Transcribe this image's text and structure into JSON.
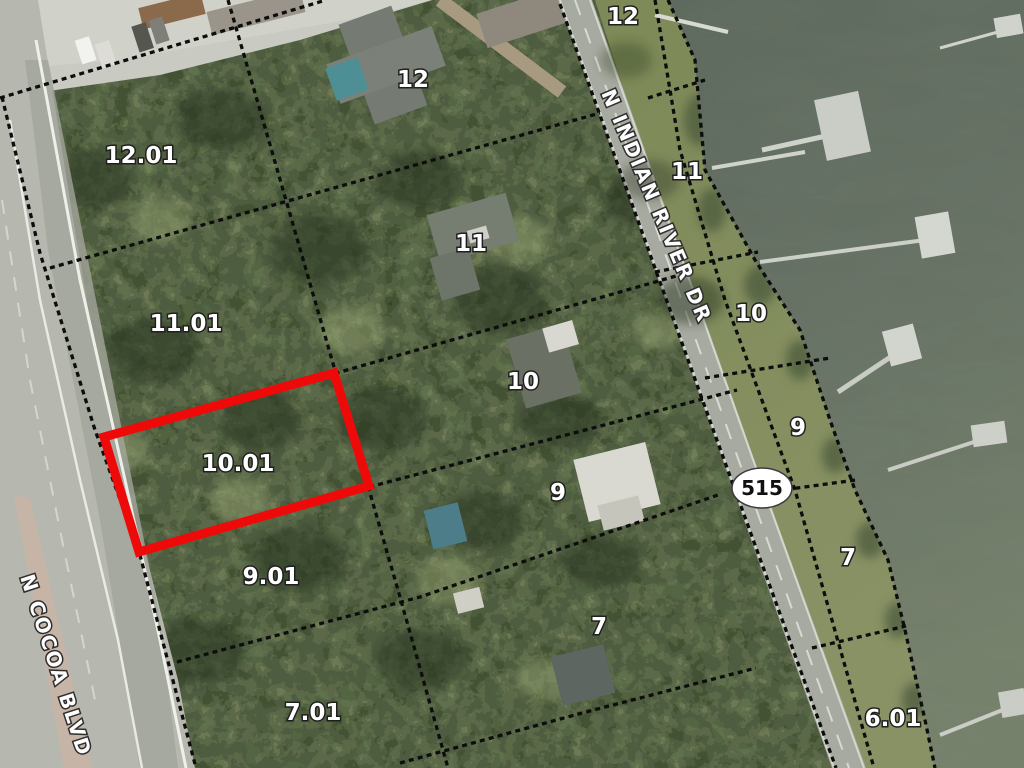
{
  "map": {
    "parcel_labels": [
      {
        "text": "12.01",
        "x": 141,
        "y": 155
      },
      {
        "text": "11.01",
        "x": 186,
        "y": 323
      },
      {
        "text": "10.01",
        "x": 238,
        "y": 463
      },
      {
        "text": "9.01",
        "x": 271,
        "y": 576
      },
      {
        "text": "7.01",
        "x": 313,
        "y": 712
      },
      {
        "text": "12",
        "x": 413,
        "y": 79
      },
      {
        "text": "11",
        "x": 471,
        "y": 243
      },
      {
        "text": "10",
        "x": 523,
        "y": 381
      },
      {
        "text": "9",
        "x": 558,
        "y": 492
      },
      {
        "text": "7",
        "x": 599,
        "y": 626
      },
      {
        "text": "12",
        "x": 623,
        "y": 16
      },
      {
        "text": "11",
        "x": 687,
        "y": 171
      },
      {
        "text": "10",
        "x": 751,
        "y": 313
      },
      {
        "text": "9",
        "x": 798,
        "y": 427
      },
      {
        "text": "7",
        "x": 848,
        "y": 557
      },
      {
        "text": "6.01",
        "x": 893,
        "y": 718
      }
    ],
    "road_labels": [
      {
        "text": "N INDIAN RIVER DR",
        "x": 601,
        "y": 93,
        "angle": 67
      },
      {
        "text": "N COCOA BLVD",
        "x": 20,
        "y": 577,
        "angle": 72
      }
    ],
    "route_shield": {
      "text": "515",
      "x": 762,
      "y": 488
    },
    "highlighted_parcel": {
      "label": "10.01",
      "color": "#ef0a0a"
    },
    "colors": {
      "boundary": "#0d0d0d",
      "label_fill": "#ffffff",
      "label_outline": "#1f1f1f",
      "water": "#64705f",
      "road_major": "#b6b8b0",
      "road_minor": "#a7aaa0",
      "highlight": "#ef0a0a"
    }
  }
}
